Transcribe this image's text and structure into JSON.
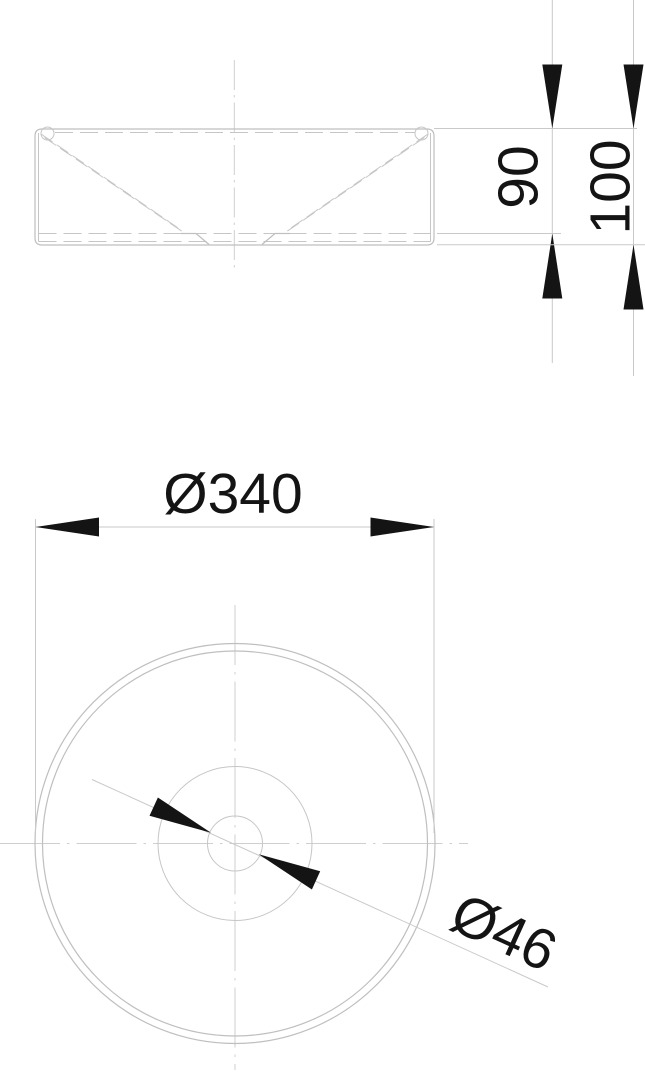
{
  "drawing": {
    "subject": "round-countertop-washbasin",
    "colors": {
      "background": "#ffffff",
      "outline": "#bfbfbf",
      "centerline": "#cfcfcf",
      "dimension_text": "#141414"
    },
    "side_view": {
      "dimensions": {
        "inner_depth": "90",
        "overall_height": "100"
      }
    },
    "top_view": {
      "dimensions": {
        "outer_diameter": "Ø340",
        "drain_diameter": "Ø46"
      }
    }
  }
}
